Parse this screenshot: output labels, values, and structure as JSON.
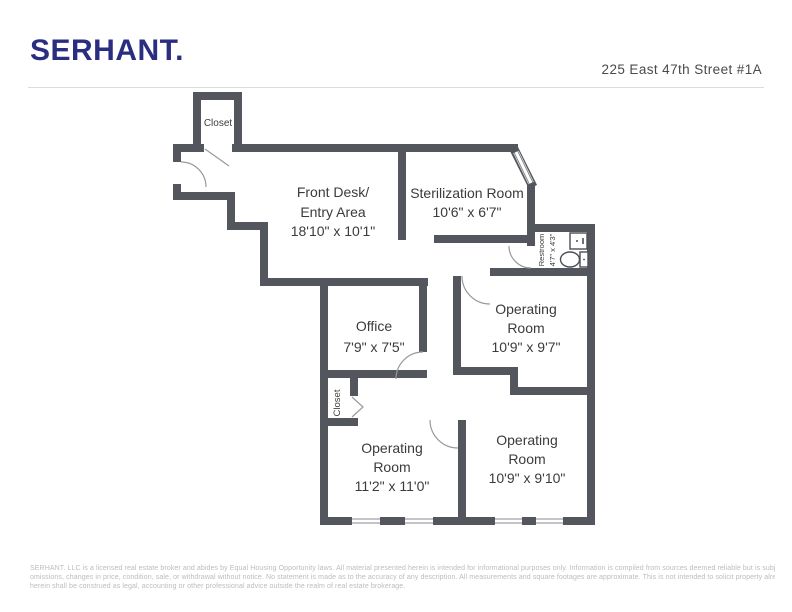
{
  "header": {
    "brand": "SERHANT.",
    "address": "225 East 47th Street #1A"
  },
  "floorplan": {
    "wall_color": "#54565e",
    "rooms": {
      "closet_top": {
        "lines": [
          "Closet"
        ]
      },
      "front_desk": {
        "lines": [
          "Front Desk/",
          "Entry Area",
          "18'10\" x 10'1\""
        ]
      },
      "sterilization": {
        "lines": [
          "Sterilization Room",
          "10'6\" x 6'7\""
        ]
      },
      "restroom": {
        "lines": [
          "Restroom",
          "4'7\" x 4'3\""
        ]
      },
      "office": {
        "lines": [
          "Office",
          "7'9\" x 7'5\""
        ]
      },
      "operating_1": {
        "lines": [
          "Operating",
          "Room",
          "10'9\" x 9'7\""
        ]
      },
      "closet_mid": {
        "lines": [
          "Closet"
        ]
      },
      "operating_2": {
        "lines": [
          "Operating",
          "Room",
          "11'2\" x 11'0\""
        ]
      },
      "operating_3": {
        "lines": [
          "Operating",
          "Room",
          "10'9\" x 9'10\""
        ]
      }
    }
  },
  "footer": {
    "lines": [
      "SERHANT. LLC is a licensed real estate broker and abides by Equal Housing Opportunity laws. All material presented herein is intended for informational purposes only. Information is compiled from sources deemed reliable but is subject to errors,",
      "omissions, changes in price, condition, sale, or withdrawal without notice. No statement is made as to the accuracy of any description. All measurements and square footages are approximate. This is not intended to solicit property already listed. Nothing",
      "herein shall be construed as legal, accounting or other professional advice outside the realm of real estate brokerage."
    ]
  }
}
